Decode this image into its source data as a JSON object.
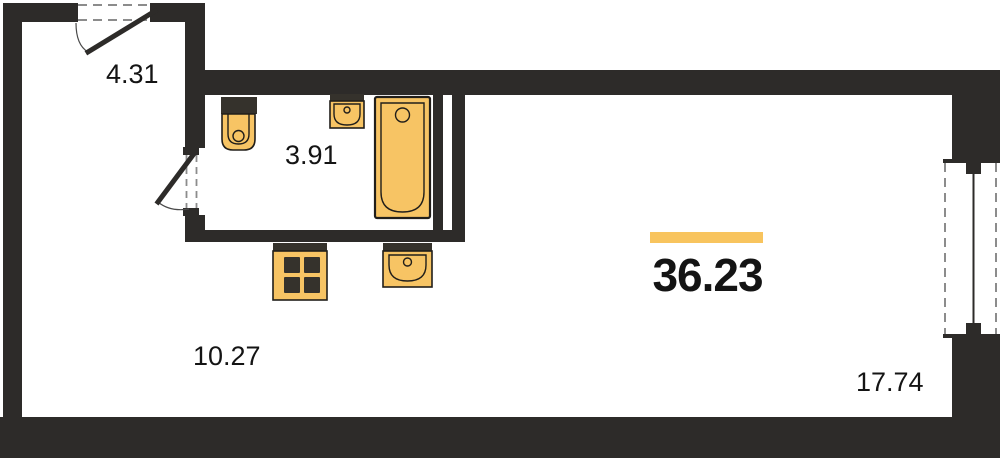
{
  "total_area": {
    "value": "36.23"
  },
  "rooms": {
    "hallway": {
      "area": "4.31"
    },
    "bathroom": {
      "area": "3.91"
    },
    "kitchen": {
      "area": "10.27"
    },
    "living": {
      "area": "17.74"
    }
  },
  "icons": {
    "fixtures": [
      "toilet-icon",
      "sink-icon",
      "bathtub-icon",
      "stove-icon",
      "kitchen-sink-icon"
    ],
    "openings": [
      "entrance-door-icon",
      "bathroom-door-icon",
      "window-icon"
    ]
  },
  "colors": {
    "wall": "#2d2b29",
    "fixture-fill": "#f7c464",
    "fixture-stroke": "#211e1a",
    "fixture-dark": "#35322c",
    "accent": "#f8c45e",
    "dash": "#8c8c8c",
    "text": "#141414",
    "bg": "#ffffff"
  }
}
